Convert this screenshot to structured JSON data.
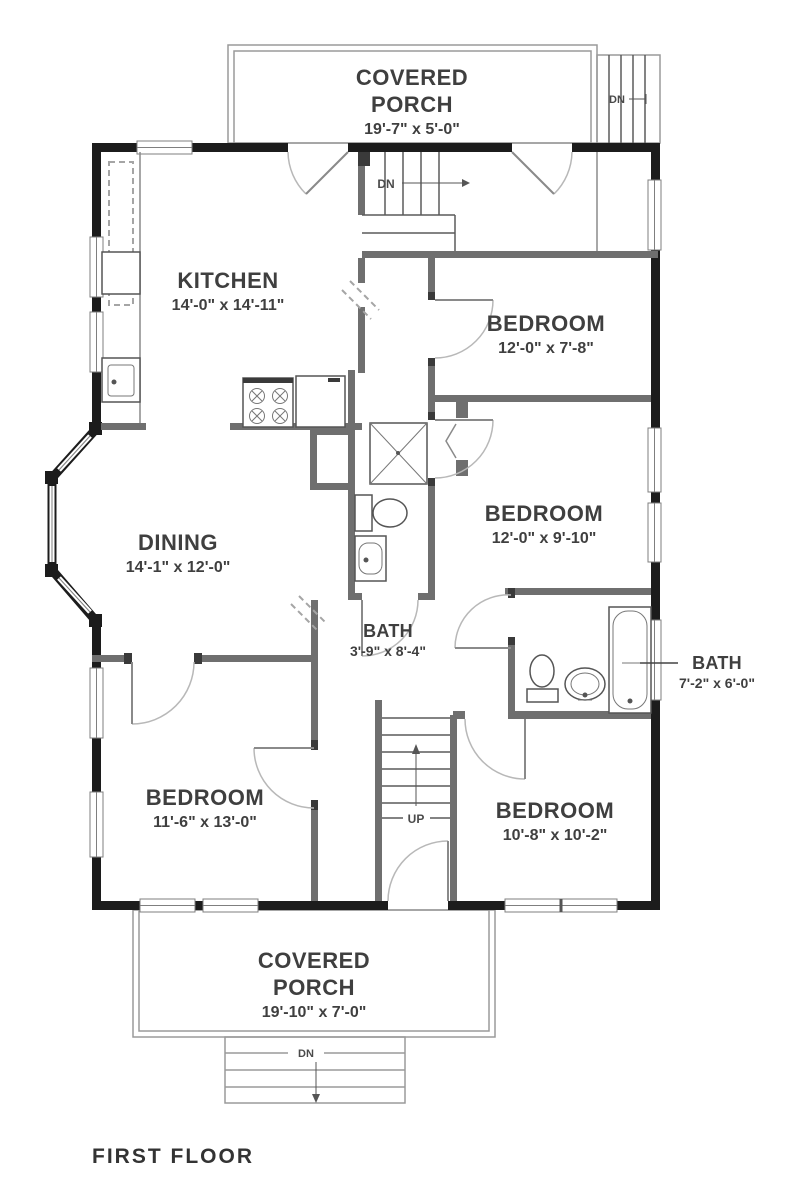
{
  "plan": {
    "footer_title": "FIRST FLOOR",
    "rooms": {
      "porch_top": {
        "line1": "COVERED",
        "line2": "PORCH",
        "dims": "19'-7\" x 5'-0\""
      },
      "kitchen": {
        "name": "KITCHEN",
        "dims": "14'-0\" x 14'-11\""
      },
      "bedroom_upper_right": {
        "name": "BEDROOM",
        "dims": "12'-0\" x 7'-8\""
      },
      "bedroom_mid_right": {
        "name": "BEDROOM",
        "dims": "12'-0\" x 9'-10\""
      },
      "dining": {
        "name": "DINING",
        "dims": "14'-1\" x 12'-0\""
      },
      "bath_center": {
        "name": "BATH",
        "dims": "3'-9\" x 8'-4\""
      },
      "bath_right": {
        "name": "BATH",
        "dims": "7'-2\" x 6'-0\""
      },
      "bedroom_lower_left": {
        "name": "BEDROOM",
        "dims": "11'-6\" x 13'-0\""
      },
      "bedroom_lower_right": {
        "name": "BEDROOM",
        "dims": "10'-8\" x 10'-2\""
      },
      "porch_bottom": {
        "line1": "COVERED",
        "line2": "PORCH",
        "dims": "19'-10\" x 7'-0\""
      }
    },
    "stair_labels": {
      "porch_top_dn": "DN",
      "entry_dn": "DN",
      "hall_up": "UP",
      "porch_bottom_dn": "DN"
    },
    "colors": {
      "exterior_wall": "#1c1c1c",
      "interior_wall": "#6f6f6f",
      "thin_line": "#9a9a9a",
      "label_text": "#3f3f3f"
    }
  }
}
